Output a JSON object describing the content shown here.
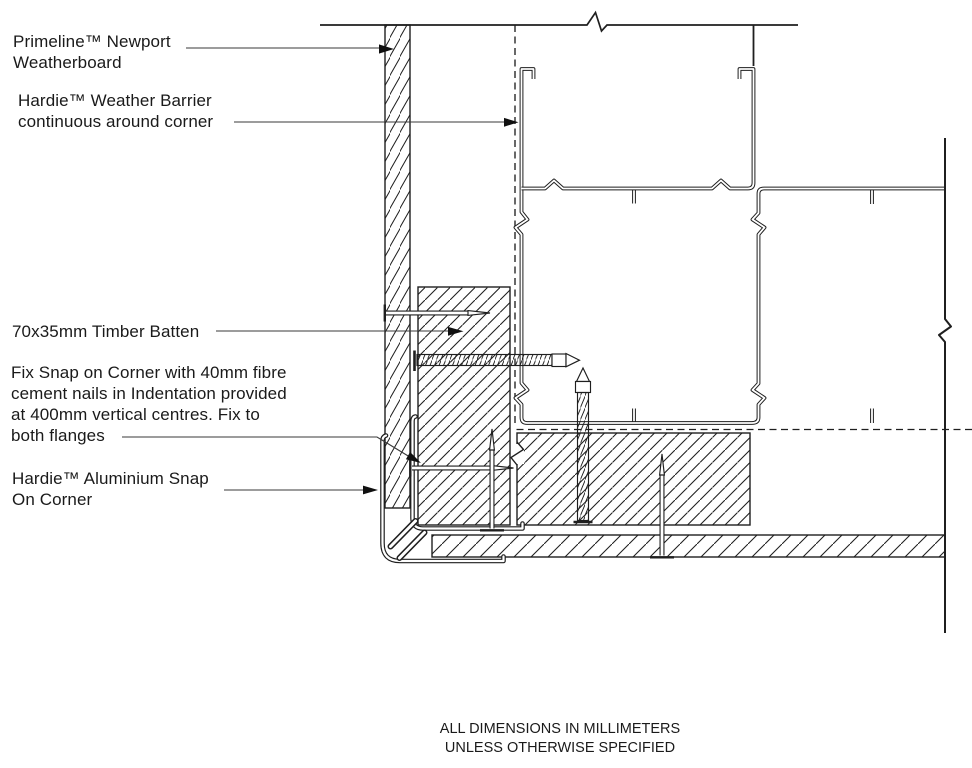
{
  "drawing": {
    "labels": {
      "weatherboard": "Primeline™ Newport\nWeatherboard",
      "weather_barrier": "Hardie™ Weather Barrier\ncontinuous around corner",
      "timber_batten": "70x35mm Timber Batten",
      "fixing_note": "Fix Snap on Corner with 40mm fibre\ncement nails in Indentation provided\nat 400mm vertical centres. Fix to\nboth flanges",
      "snap_on_corner": "Hardie™ Aluminium Snap\nOn Corner"
    },
    "footer_note": "ALL DIMENSIONS IN MILLIMETERS\nUNLESS OTHERWISE SPECIFIED",
    "colors": {
      "line": "#1f1f1f",
      "leader": "#3a3a3a",
      "arrow": "#101010",
      "background": "#ffffff"
    }
  }
}
